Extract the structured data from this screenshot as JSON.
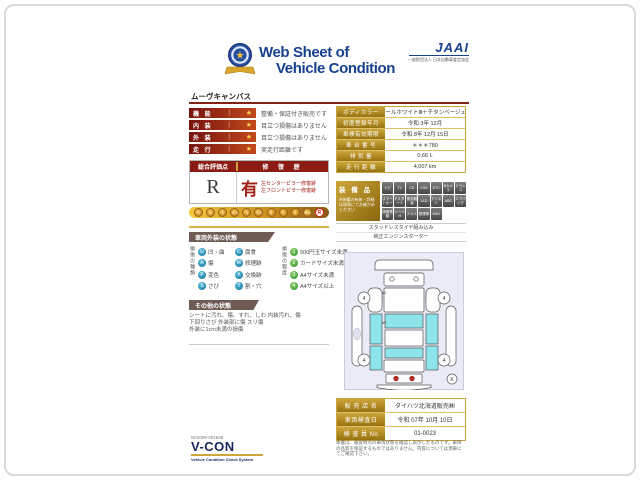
{
  "header": {
    "title_line1": "Web Sheet of",
    "title_line2": "Vehicle Condition",
    "jaai_logo": "JAAI",
    "jaai_subtext": "一般財団法人 日本自動車査定協会"
  },
  "model_name": "ムーヴキャンバス",
  "ratings": [
    {
      "label": "機 能",
      "star": "★",
      "text": "整備・保証付き販売です"
    },
    {
      "label": "内 装",
      "star": "★",
      "text": "目立つ損傷はありません"
    },
    {
      "label": "外 装",
      "star": "★",
      "text": "目立つ損傷はありません"
    },
    {
      "label": "走 行",
      "star": "★",
      "text": "実走行距離です"
    }
  ],
  "evaluation": {
    "header_left": "総合評価点",
    "header_right": "修 復 歴",
    "grade": "R",
    "repair_flag": "有",
    "repair_notes": [
      "左センターピラー修復跡",
      "左フロントピラー修復跡"
    ],
    "scale": [
      "S",
      "6",
      "5",
      "4.5",
      "4",
      "3.5",
      "3",
      "2",
      "1",
      "RA",
      "R"
    ],
    "scale_selected": "R"
  },
  "vehicle_info": [
    {
      "label": "ボディカラー",
      "value": "パールホワイトⅢ＋チタンベージュM"
    },
    {
      "label": "初度登録年月",
      "value": "令和 3年 12月"
    },
    {
      "label": "車検有効期限",
      "value": "令和 8年 12月 15日"
    },
    {
      "label": "車 台 番 号",
      "value": "＊＊＊780"
    },
    {
      "label": "排 気 量",
      "value": "0.66 L"
    },
    {
      "label": "走 行 距 離",
      "value": "4,007 km"
    }
  ],
  "equipment": {
    "title": "装 備 品",
    "note": "※装備の有無・詳細は現車にてお確かめください",
    "badges": [
      "ナビ",
      "TV",
      "CD",
      "DVD",
      "ETC",
      "Bカメラ",
      "ドラレコ",
      "スマートキー",
      "Pスタート",
      "衝突軽減",
      "LED",
      "アイスト",
      "ABS",
      "エアバッグ",
      "両側電動",
      "シートH",
      "アルミ",
      "禁煙車",
      "4WD"
    ],
    "notes": [
      "スタッドレスタイヤ組み込み",
      "純正エンジンスターター"
    ]
  },
  "exterior_condition": {
    "title": "車両外装の状態",
    "damage_types_label": "損傷の種類",
    "damage_types": [
      {
        "code": "U",
        "label": "凹・曲"
      },
      {
        "code": "C",
        "label": "腐食"
      },
      {
        "code": "A",
        "label": "傷"
      },
      {
        "code": "W",
        "label": "修理跡"
      },
      {
        "code": "P",
        "label": "変色"
      },
      {
        "code": "X",
        "label": "交換跡"
      },
      {
        "code": "S",
        "label": "さび"
      },
      {
        "code": "T",
        "label": "割・穴"
      }
    ],
    "damage_degree_label": "損傷の程度",
    "damage_degrees": [
      {
        "code": "1",
        "label": "500円玉サイズ未満"
      },
      {
        "code": "2",
        "label": "カードサイズ未満"
      },
      {
        "code": "3",
        "label": "A4サイズ未満"
      },
      {
        "code": "4",
        "label": "A4サイズ以上"
      }
    ]
  },
  "other_condition": {
    "title": "その他の状態",
    "lines": [
      "シートに汚れ、傷、すれ、しわ 内装汚れ、傷",
      "下回りさび 外装部に傷 スリ傷",
      "外装に1cm未満の損傷"
    ]
  },
  "diagram": {
    "wheel_mark": "4",
    "corner_mark": "K",
    "markers": [
      "W",
      "W"
    ]
  },
  "sales": [
    {
      "label": "販 売 店 名",
      "value": "ダイハツ北海道販売㈱"
    },
    {
      "label": "車両検査日",
      "value": "令和 07年 10月 10日"
    },
    {
      "label": "検 査 員 No",
      "value": "01-0023"
    }
  ],
  "footer": {
    "serial": "N01009-001629",
    "vcon": "V-CON",
    "vcon_sub": "Vehicle Condition Check System",
    "disclaimer": "本書は、検査時点の車両状態を確認し表示したものです。車両の品質を保証するものではありません。内容については現車にてご確認下さい。"
  },
  "colors": {
    "title_blue": "#17418e",
    "label_red": "#8c1b14",
    "label_gold": "#cda63a",
    "panel_cyan": "#8de4ea",
    "repair_red": "#a11f14"
  }
}
